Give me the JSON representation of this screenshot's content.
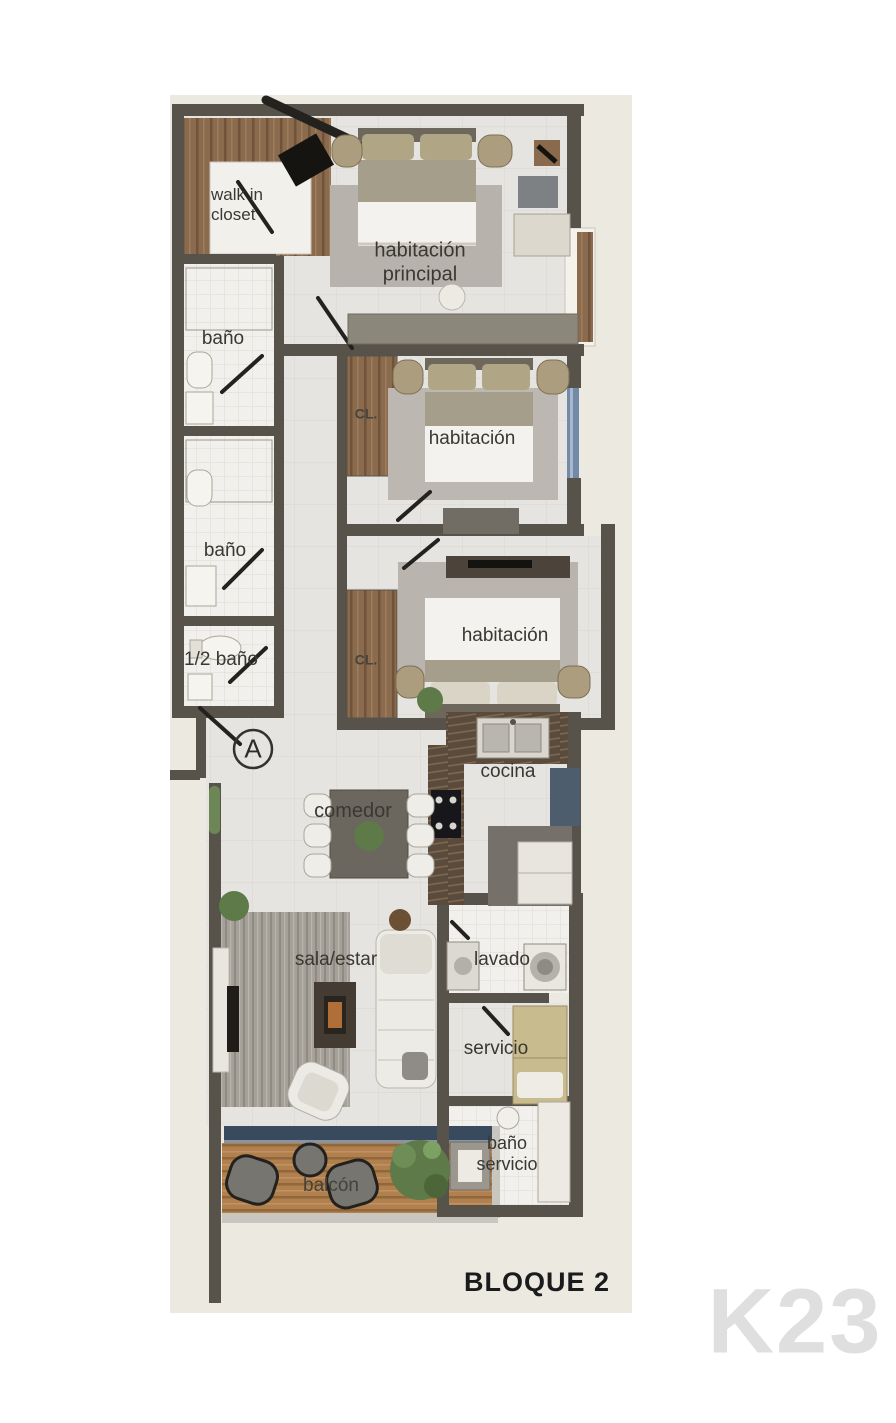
{
  "plan": {
    "title": "BLOQUE 2",
    "watermark": "K23",
    "section_marker": "A"
  },
  "labels": {
    "walk_closet": "walk in\ncloset",
    "habitacion_principal": "habitación\nprincipal",
    "banio_1": "baño",
    "closet_1": "CL.",
    "habitacion_2": "habitación",
    "banio_2": "baño",
    "medio_banio": "1/2 baño",
    "closet_2": "CL.",
    "habitacion_3": "habitación",
    "cocina": "cocina",
    "comedor": "comedor",
    "sala_estar": "sala/estar",
    "lavado": "lavado",
    "servicio": "servicio",
    "banio_servicio": "baño\nservicio",
    "balcon": "balcón"
  },
  "colors": {
    "sheet_background": "#ece9e0",
    "wall": "#57534a",
    "wood_floor": "#8b6b4d",
    "balcony_wood": "#b0804e",
    "window_blue": "#7289a8",
    "slider_navy": "#3a4a5e",
    "rug_gray": "#b7b3ac",
    "label_text": "#3a3833",
    "title_text": "#1a1b1d",
    "watermark_text": "#dfdfdf",
    "plant_green": "#5d7a48"
  }
}
